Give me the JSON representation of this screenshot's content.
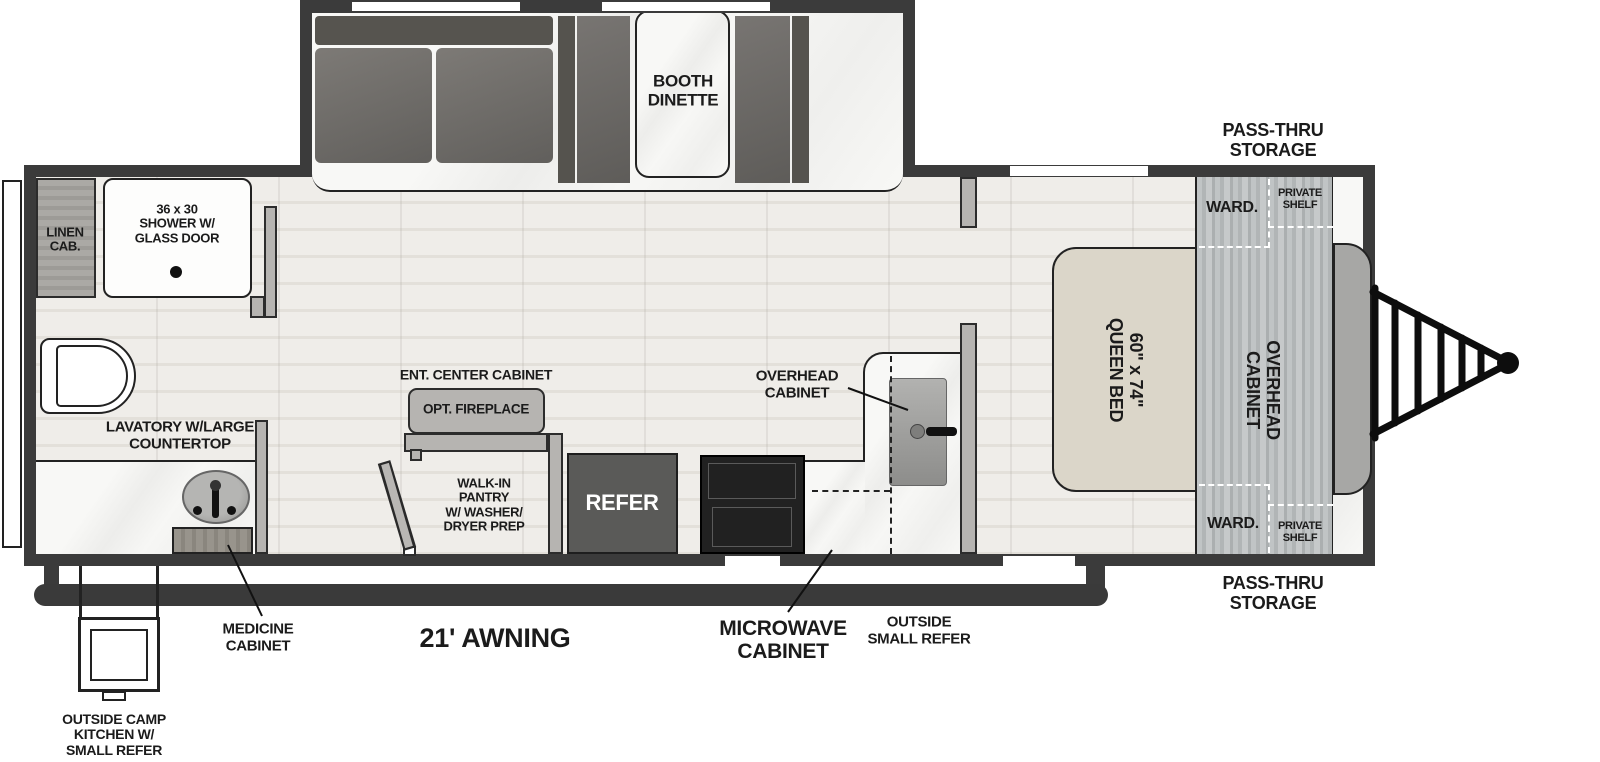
{
  "labels": {
    "linen_cab": "LINEN\nCAB.",
    "shower": "36 x 30\nSHOWER W/\nGLASS DOOR",
    "lavatory": "LAVATORY W/LARGE\nCOUNTERTOP",
    "medicine_cabinet": "MEDICINE\nCABINET",
    "outside_camp_kitchen": "OUTSIDE CAMP\nKITCHEN W/\nSMALL REFER",
    "awning": "21' AWNING",
    "ent_center_cabinet": "ENT. CENTER CABINET",
    "opt_fireplace": "OPT. FIREPLACE",
    "walk_in_pantry": "WALK-IN\nPANTRY\nW/ WASHER/\nDRYER PREP",
    "refer": "REFER",
    "overhead_cabinet_kitchen": "OVERHEAD\nCABINET",
    "microwave_cabinet": "MICROWAVE\nCABINET",
    "outside_small_refer": "OUTSIDE\nSMALL REFER",
    "booth_dinette": "BOOTH\nDINETTE",
    "pass_thru_storage_top": "PASS-THRU\nSTORAGE",
    "pass_thru_storage_bottom": "PASS-THRU\nSTORAGE",
    "ward_top": "WARD.",
    "ward_bottom": "WARD.",
    "private_shelf_top": "PRIVATE\nSHELF",
    "private_shelf_bottom": "PRIVATE\nSHELF",
    "queen_bed": "60\" x 74\"\nQUEEN BED",
    "overhead_cabinet_front": "OVERHEAD\nCABINET"
  },
  "colors": {
    "wall": "#3b3b3b",
    "furniture_dark": "#6b6966",
    "furniture_backrest": "#56544f",
    "refer_box": "#5a5a58",
    "stove": "#212121",
    "bed": "#dbd6c9",
    "front_cap": "#a7a7a5",
    "label_text": "#1b1b1b"
  }
}
